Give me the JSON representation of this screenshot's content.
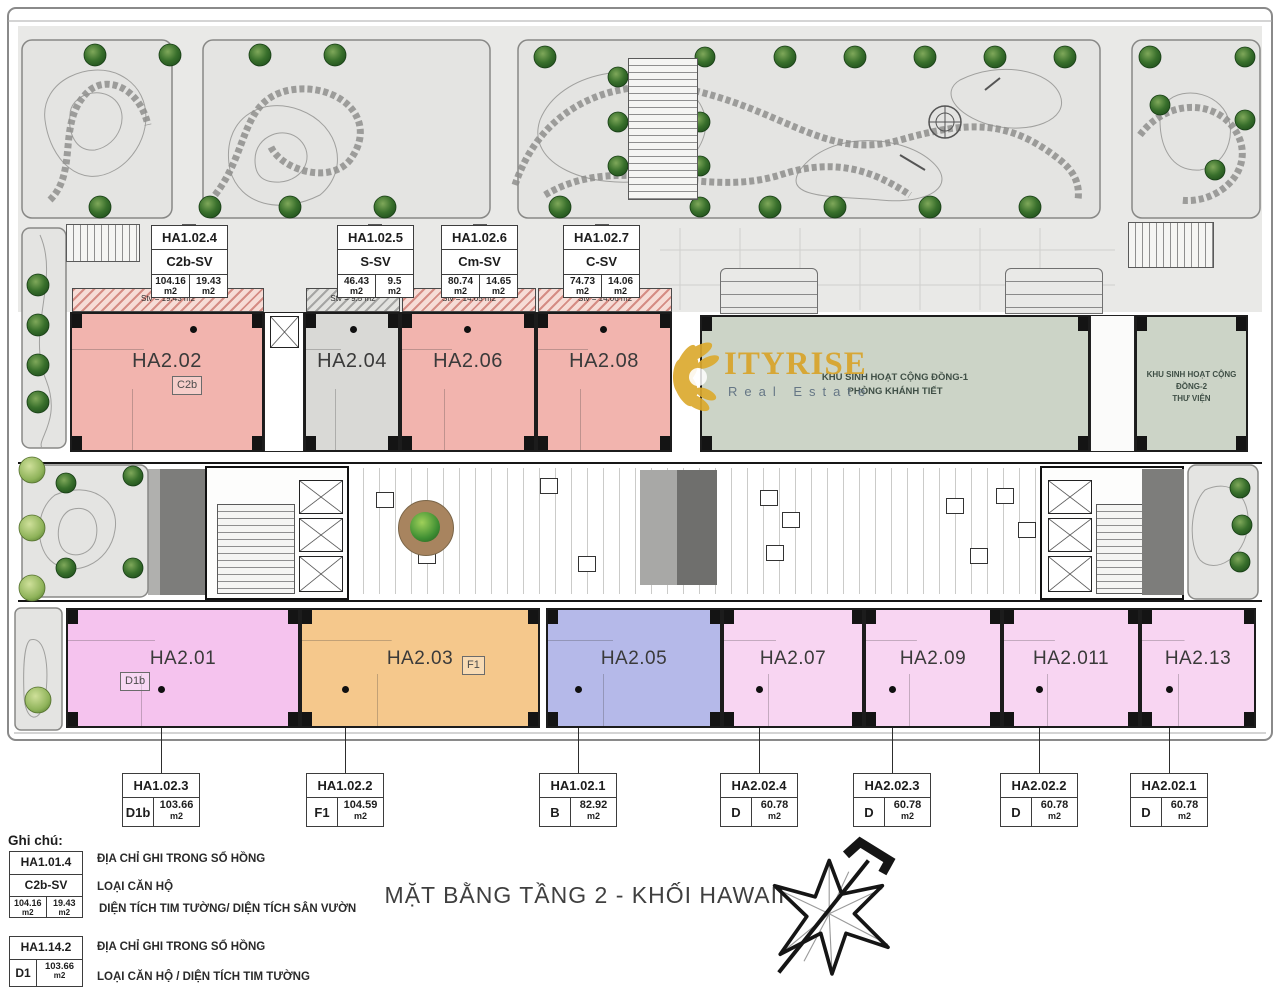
{
  "title": "MẶT BẰNG TẦNG 2 - KHỐI HAWAII",
  "m2": "m2",
  "watermark": {
    "brand": "ITYRISE",
    "tagline": "Real Estate"
  },
  "top_labels": [
    {
      "code": "HA1.02.4",
      "type": "C2b-SV",
      "area_main": "104.16",
      "area_garden": "19.43"
    },
    {
      "code": "HA1.02.5",
      "type": "S-SV",
      "area_main": "46.43",
      "area_garden": "9.5"
    },
    {
      "code": "HA1.02.6",
      "type": "Cm-SV",
      "area_main": "80.74",
      "area_garden": "14.65"
    },
    {
      "code": "HA1.02.7",
      "type": "C-SV",
      "area_main": "74.73",
      "area_garden": "14.06"
    }
  ],
  "middle_units": [
    {
      "name": "HA2.02",
      "tag": "C2b",
      "stv": "Stv = 19.43 m2"
    },
    {
      "name": "HA2.04",
      "stv": "Stv = 9.5 m2"
    },
    {
      "name": "HA2.06",
      "stv": "Stv = 14.65 m2"
    },
    {
      "name": "HA2.08",
      "stv": "Stv = 14.06 m2"
    }
  ],
  "community_rooms": [
    {
      "line1": "KHU SINH HOẠT CỘNG ĐỒNG-1",
      "line2": "PHÒNG KHÁNH TIẾT"
    },
    {
      "line1": "KHU SINH HOẠT CỘNG ĐỒNG-2",
      "line2": "THƯ VIỆN"
    }
  ],
  "bottom_units": [
    {
      "name": "HA2.01",
      "tag": "D1b"
    },
    {
      "name": "HA2.03",
      "tag": "F1"
    },
    {
      "name": "HA2.05"
    },
    {
      "name": "HA2.07"
    },
    {
      "name": "HA2.09"
    },
    {
      "name": "HA2.011"
    },
    {
      "name": "HA2.13"
    }
  ],
  "bottom_labels": [
    {
      "code": "HA1.02.3",
      "type": "D1b",
      "area": "103.66"
    },
    {
      "code": "HA1.02.2",
      "type": "F1",
      "area": "104.59"
    },
    {
      "code": "HA1.02.1",
      "type": "B",
      "area": "82.92"
    },
    {
      "code": "HA2.02.4",
      "type": "D",
      "area": "60.78"
    },
    {
      "code": "HA2.02.3",
      "type": "D",
      "area": "60.78"
    },
    {
      "code": "HA2.02.2",
      "type": "D",
      "area": "60.78"
    },
    {
      "code": "HA2.02.1",
      "type": "D",
      "area": "60.78"
    }
  ],
  "legend": {
    "heading": "Ghi chú:",
    "item1": {
      "code": "HA1.01.4",
      "type": "C2b-SV",
      "area_main": "104.16",
      "area_garden": "19.43",
      "note_code": "ĐỊA CHỈ GHI TRONG SỔ HỒNG",
      "note_type": "LOẠI CĂN HỘ",
      "note_area": "DIỆN TÍCH TIM TƯỜNG/ DIỆN TÍCH SÂN VƯỜN"
    },
    "item2": {
      "code": "HA1.14.2",
      "type": "D1",
      "area": "103.66",
      "note_code": "ĐỊA CHỈ GHI TRONG SỔ HỒNG",
      "note_type": "LOẠI CĂN HỘ / DIỆN TÍCH TIM TƯỜNG"
    }
  },
  "colors": {
    "unit_pink": "#f2b4ae",
    "unit_gray": "#d9d9d6",
    "community_green": "#ccd4c7",
    "unit_magenta": "#f5c3ee",
    "unit_orange": "#f5c88c",
    "unit_blue": "#b5b9e9",
    "unit_lightpink": "#f8d5f2",
    "brand_gold": "#d9a42a"
  }
}
